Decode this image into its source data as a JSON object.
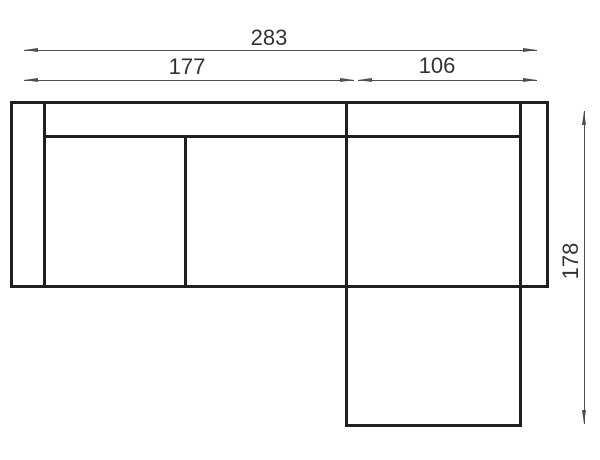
{
  "drawing": {
    "title": "corner-sofa-top-view-dimension-drawing",
    "dimensions": {
      "total_width": "283",
      "left_section_width": "177",
      "chaise_section_width": "106",
      "depth": "178"
    }
  },
  "colors": {
    "background": "#ffffff",
    "outline": "#1f1f1f",
    "dimension_line": "#4f4f4f",
    "text": "#333333"
  }
}
